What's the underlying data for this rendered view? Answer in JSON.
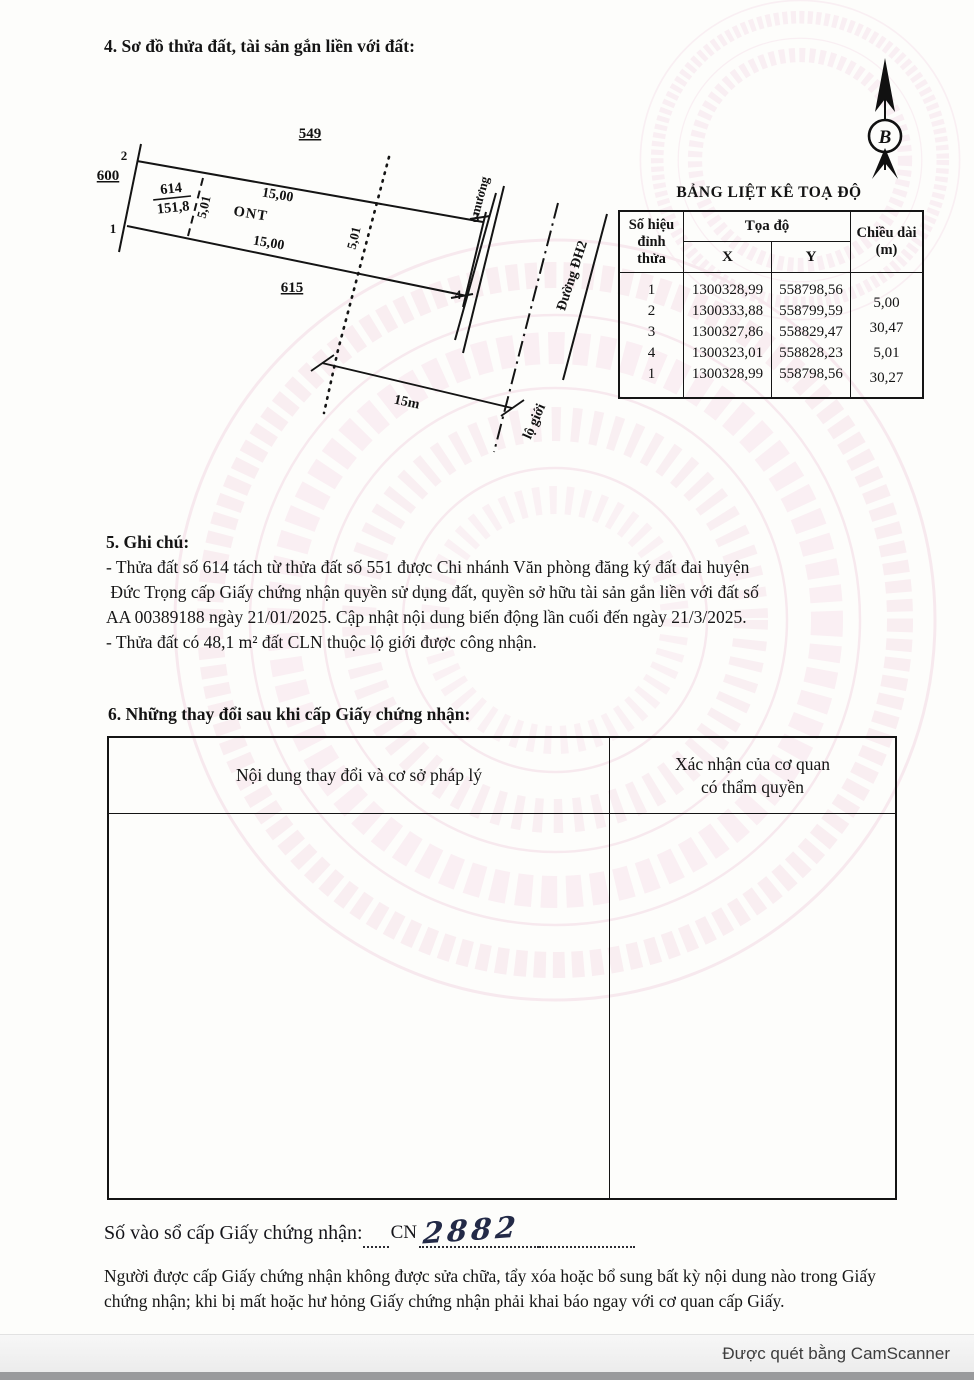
{
  "document": {
    "section4": {
      "title": "4. Sơ đồ thửa đất, tài sản gắn liền với đất:"
    },
    "diagram": {
      "north_letter": "B",
      "neighbor_top": "549",
      "neighbor_left": "600",
      "neighbor_bottom": "615",
      "parcel_no": "614",
      "parcel_area": "151,8",
      "land_type": "ONT",
      "len_top": "15,00",
      "len_bottom": "15,00",
      "width_mid": "5,01",
      "width_right": "5,01",
      "pt1": "1",
      "pt2": "2",
      "pt3": "3",
      "pt4": "4",
      "canal": "mương",
      "road_name": "Đường ĐH2",
      "road_width": "15m",
      "road_boundary": "lộ giới"
    },
    "coord_table": {
      "title": "BẢNG LIỆT KÊ TOẠ ĐỘ",
      "header": {
        "vertex": "Số hiệu đỉnh thửa",
        "coord": "Tọa độ",
        "x": "X",
        "y": "Y",
        "length": "Chiều dài (m)"
      },
      "vertices": [
        "1",
        "2",
        "3",
        "4",
        "1"
      ],
      "x_values": [
        "1300328,99",
        "1300333,88",
        "1300327,86",
        "1300323,01",
        "1300328,99"
      ],
      "y_values": [
        "558798,56",
        "558799,59",
        "558829,47",
        "558828,23",
        "558798,56"
      ],
      "lengths": [
        "5,00",
        "30,47",
        "5,01",
        "30,27"
      ]
    },
    "section5": {
      "title": "5. Ghi chú:",
      "line1": "- Thửa đất số 614 tách từ thửa đất số 551 được Chi nhánh Văn phòng đăng ký đất đai huyện",
      "line2": " Đức Trọng cấp Giấy chứng nhận quyền sử dụng đất, quyền sở hữu tài sản gắn liền với đất số",
      "line3": "AA 00389188 ngày 21/01/2025. Cập nhật nội dung biến động lần cuối đến ngày 21/3/2025.",
      "line4": "- Thửa đất có 48,1 m² đất CLN thuộc lộ giới được công nhận."
    },
    "section6": {
      "title": "6. Những thay đổi sau khi cấp Giấy chứng nhận:",
      "col_change": "Nội dung thay đổi và cơ sở pháp lý",
      "col_confirm_line1": "Xác nhận của cơ quan",
      "col_confirm_line2": "có thẩm quyền"
    },
    "registry": {
      "label": "Số vào sổ cấp Giấy chứng nhận:",
      "prefix": "CN",
      "number": "2882"
    },
    "note": "Người được cấp Giấy chứng nhận không được sửa chữa, tẩy xóa hoặc bổ sung bất kỳ nội dung nào trong Giấy chứng nhận; khi bị mất hoặc hư hỏng Giấy chứng nhận phải khai báo ngay với cơ quan cấp Giấy.",
    "scanner_bar": {
      "text": "Được quét bằng CamScanner"
    },
    "watermark_color": "#f3d9e5"
  }
}
